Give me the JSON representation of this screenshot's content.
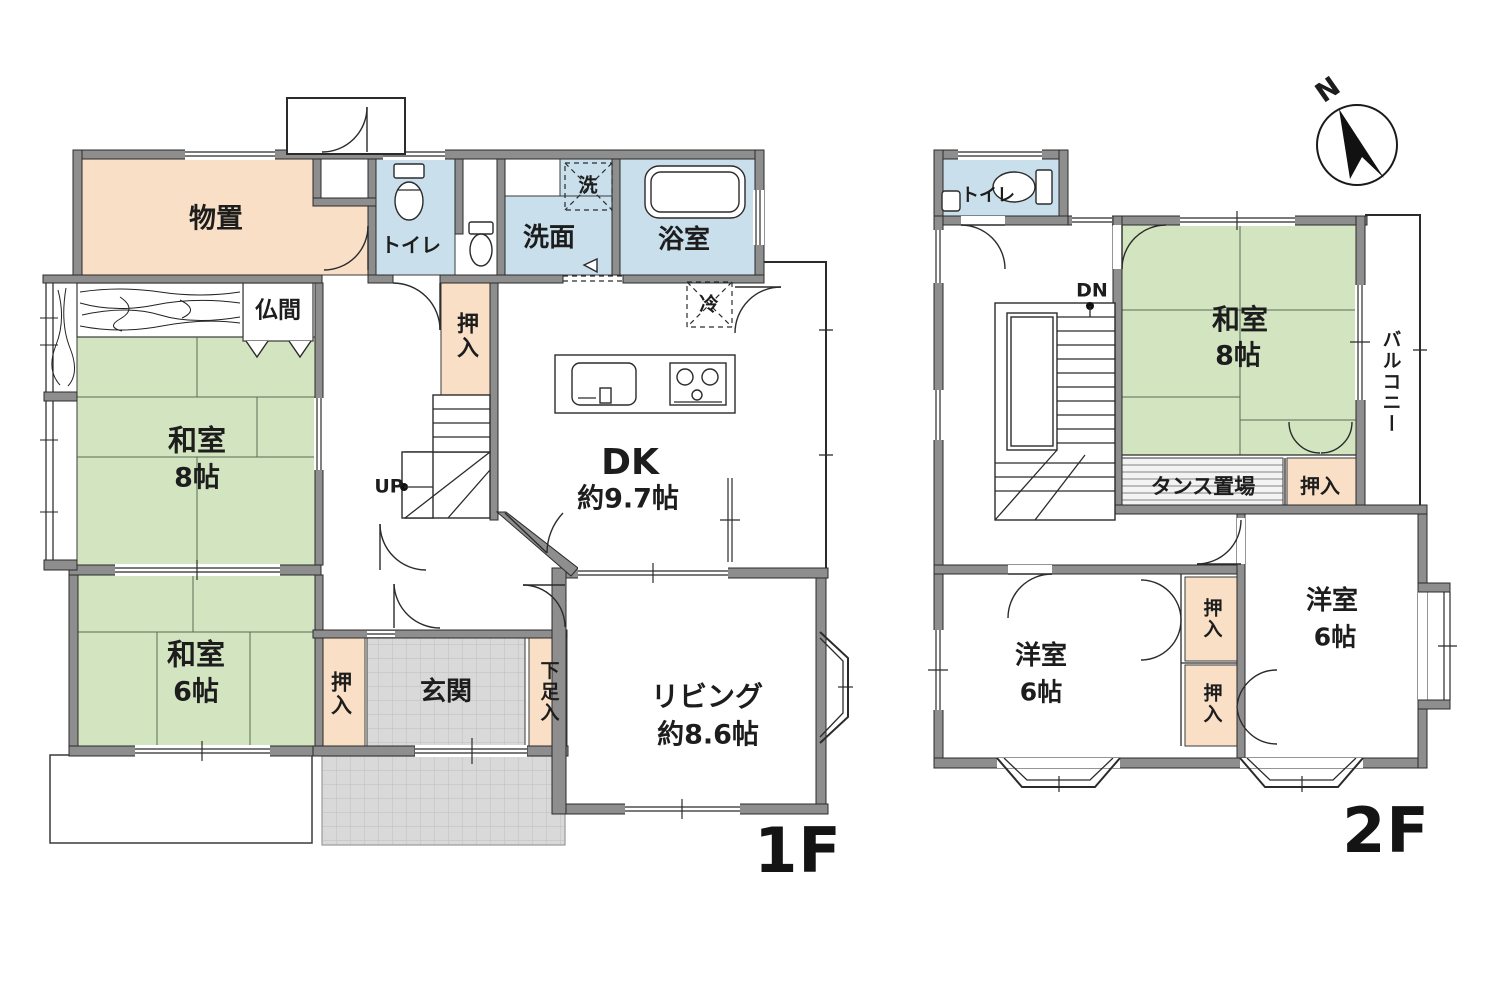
{
  "floor1": {
    "floor_label": "1F",
    "storage": "物置",
    "toilet": "トイレ",
    "washroom": "洗面",
    "washer_mark": "洗",
    "bathroom": "浴室",
    "fridge_mark": "冷",
    "butsuma": "仏間",
    "washitsu8": {
      "name": "和室",
      "size": "8帖"
    },
    "washitsu6": {
      "name": "和室",
      "size": "6帖"
    },
    "oshiire": "押入",
    "stairs_up": "UP",
    "dk": {
      "name": "DK",
      "size": "約9.7帖"
    },
    "living": {
      "name": "リビング",
      "size": "約8.6帖"
    },
    "genkan": "玄関",
    "shoe_closet": "下足入"
  },
  "floor2": {
    "floor_label": "2F",
    "toilet": "トイレ",
    "stairs_down": "DN",
    "washitsu8": {
      "name": "和室",
      "size": "8帖"
    },
    "balcony": "バルコニー",
    "tansu": "タンス置場",
    "oshiire": "押入",
    "youshitsu_left": {
      "name": "洋室",
      "size": "6帖"
    },
    "youshitsu_right": {
      "name": "洋室",
      "size": "6帖"
    }
  },
  "compass": {
    "north": "N"
  },
  "colors": {
    "tatami_green": "#d3e4c1",
    "wet_blue": "#c9dfec",
    "closet_peach": "#f8dfc5",
    "wall_gray": "#8e8e8e",
    "tile_gray": "#dadada"
  }
}
